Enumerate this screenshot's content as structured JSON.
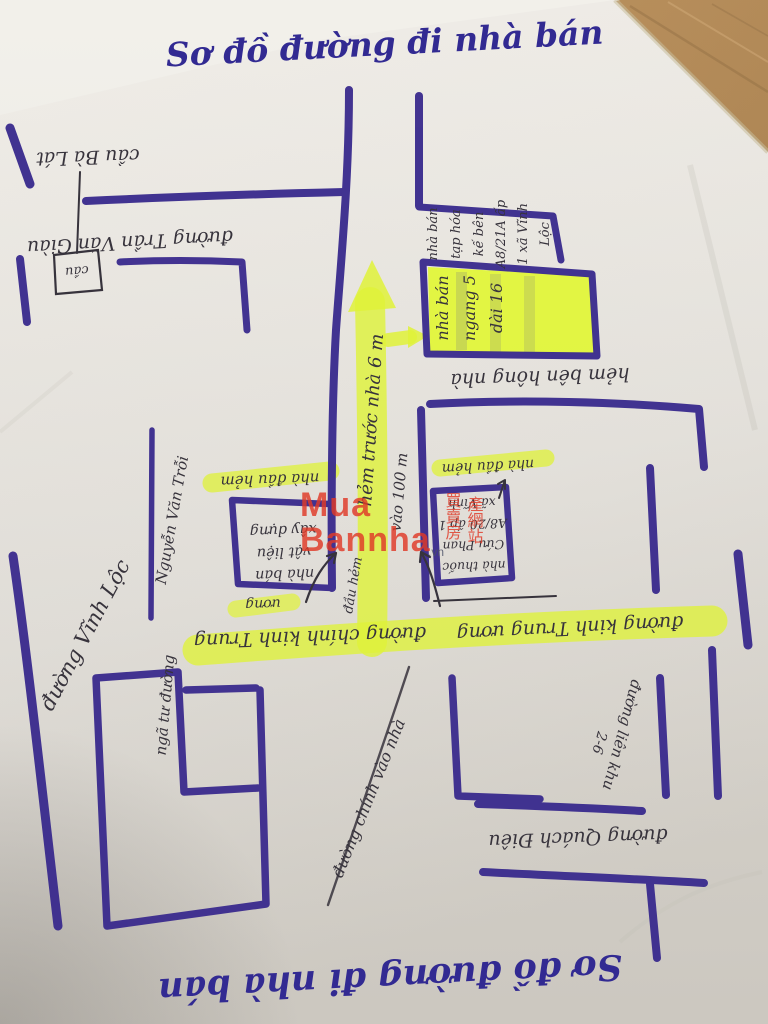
{
  "scene": {
    "paper_color": "#e9e6e0",
    "under_sheet_color": "#f1efe9",
    "wood_color": "#b08048",
    "marker_purple": "#3b2c8e",
    "pen_black": "#37333c",
    "highlighter_yellow": "#dff238"
  },
  "titles": {
    "top": "Sơ đồ đường đi nhà bán",
    "bottom": "Sơ đồ đường đi nhà bán"
  },
  "labels": {
    "bridge_name": "cầu Bà Lát",
    "bridge_box": "cầu",
    "street_tran_van_giau": "đường Trần Văn Giàu",
    "house_info_lines": [
      "nhà bán",
      "tạp hóa",
      "kế bên",
      "A8/21A ấp",
      "1 xã Vĩnh",
      "Lộc"
    ],
    "house_dim_lines": [
      "nhà bán",
      "ngang 5",
      "dài 16"
    ],
    "alley_side": "hẻm bên hông nhà",
    "alley_front": "hẻm trước nhà 6 m",
    "go_in": "vào 100 m",
    "alley_start": "đầu hẻm",
    "corner_house_left": "nhà đầu hẻm",
    "corner_house_right": "nhà đầu hẻm",
    "materials_lines": [
      "nhà bán",
      "vật liệu",
      "xây dựng"
    ],
    "pharmacy_lines": [
      "nhà thuốc",
      "Cứu Phan",
      "A8/20 ấp 1",
      "xã Vĩnh"
    ],
    "main_road_left": "đường chính kinh Trung",
    "main_road_left_small": "ương",
    "main_road_right": "đường kinh Trung ương",
    "crossroad": "ngã tư đường",
    "street_nguyen_van_troi": "Nguyễn Văn Trỗi",
    "street_vinh_loc": "đường Vĩnh Lộc",
    "road_to_house": "đường chính vào nhà",
    "street_lien_khu": "đường liên khu",
    "street_lien_khu_num": "2-6",
    "street_quach_dieu": "đường Quách Điêu"
  },
  "watermark": {
    "brand_line1": "Mua",
    "brand_line2": "Bannha",
    "brand_suffix": ".vn",
    "seal_col1": "買賣房",
    "seal_col2": "產網站"
  }
}
